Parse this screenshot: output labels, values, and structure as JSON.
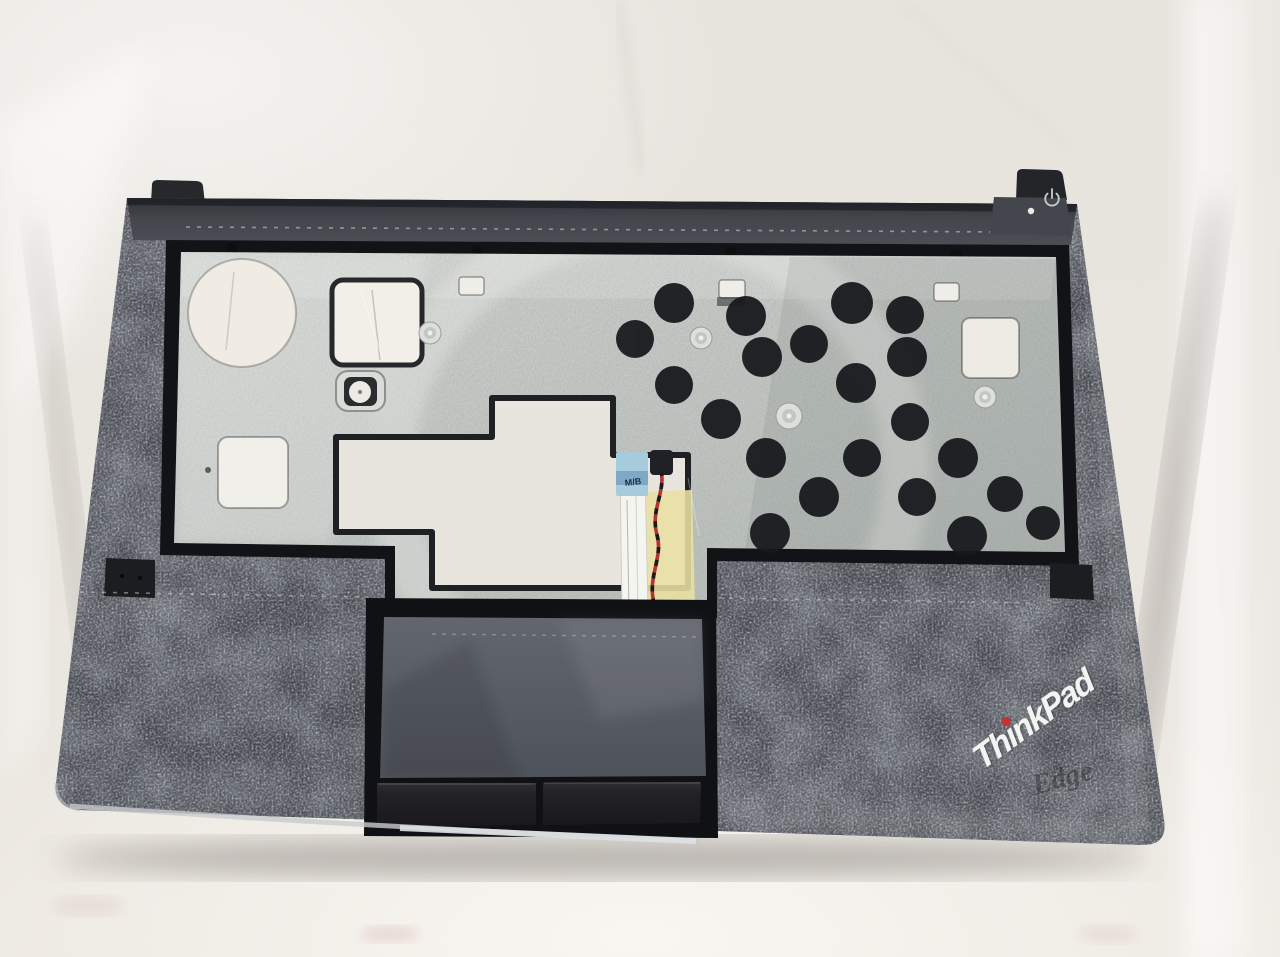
{
  "photo": {
    "subject": "Laptop palmrest top cover assembly (inside view) lying on white fabric",
    "labels": {
      "brand": "ThinkPad",
      "series_ghost": "Edge",
      "cable_tag": "M/B"
    },
    "icons": {
      "power": "power-icon",
      "status_led": "led-dot"
    },
    "colors": {
      "fabric": "#e9e5df",
      "body_dark": "#45484e",
      "frame_black": "#131417",
      "metal_plate": "#c2c6c3",
      "touchpad": "#5a5e65",
      "buttons": "#232327",
      "kapton_tape": "#e9e0a2",
      "ffc_tab_blue": "#a6cbdd",
      "wire_red": "#b03430",
      "logo_white": "#f4f4f4",
      "logo_dot_red": "#c9302f"
    },
    "components": [
      "hinge strip with corner tabs",
      "power button tab with power icon and LED dot",
      "silver keyboard backplate with cutouts",
      "round speaker hole",
      "adhesive black pads",
      "metal rivets",
      "touchpad mounting cutout outline",
      "motherboard FFC ribbon cable with M/B tab",
      "red-black twisted wire with connector",
      "kapton tape patch",
      "touchpad recess",
      "left touchpad button",
      "right touchpad button",
      "ThinkPad logo with red dot",
      "embossed Edge wordmark"
    ]
  }
}
